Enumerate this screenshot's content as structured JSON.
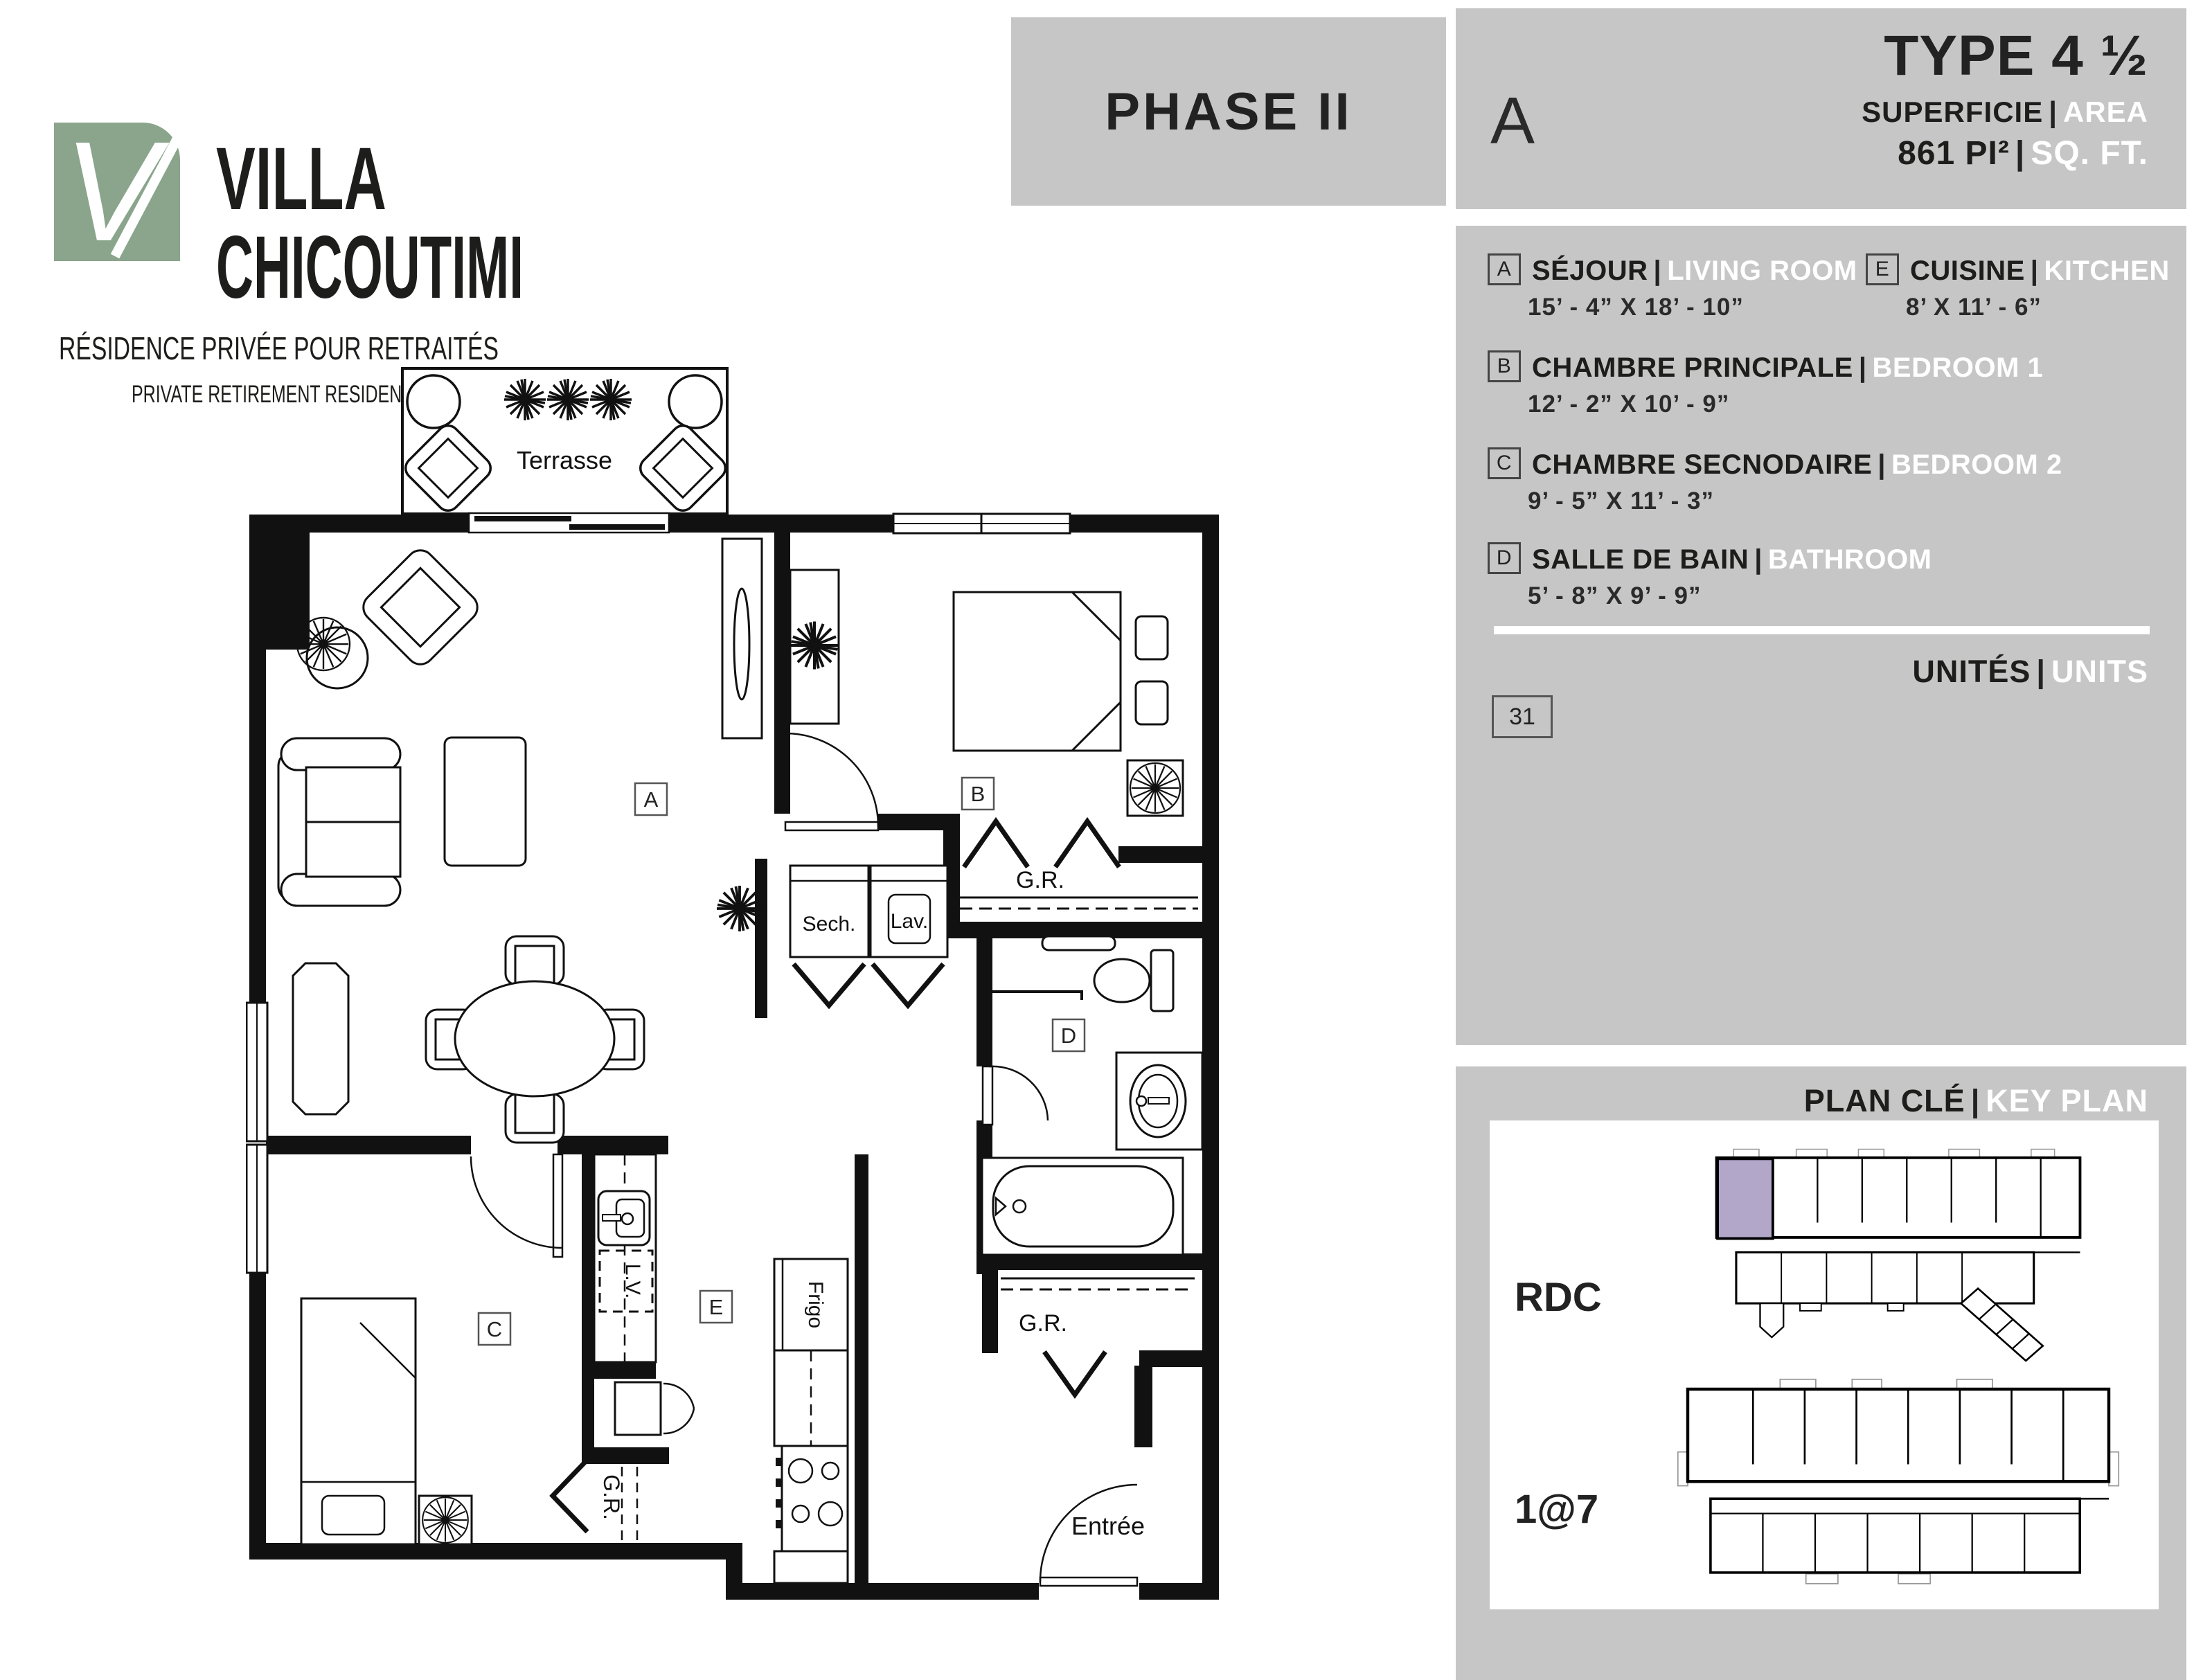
{
  "brand": {
    "name_line1": "VILLA",
    "name_line2": "CHICOUTIMI",
    "tagline_fr": "RÉSIDENCE PRIVÉE POUR RETRAITÉS",
    "tagline_en": "PRIVATE RETIREMENT RESIDENCE",
    "monogram": "V"
  },
  "phase": {
    "label": "PHASE II"
  },
  "unit_header": {
    "unit_letter": "A",
    "type_label": "TYPE 4 ½",
    "superficie_fr": "SUPERFICIE",
    "superficie_en": "AREA",
    "area_value_fr": "861 PI²",
    "area_value_en": "SQ. FT."
  },
  "legend": {
    "items": [
      {
        "badge": "A",
        "name_fr": "SÉJOUR",
        "name_en": "LIVING ROOM",
        "dims": "15’ - 4” X 18’ - 10”"
      },
      {
        "badge": "B",
        "name_fr": "CHAMBRE PRINCIPALE",
        "name_en": "BEDROOM 1",
        "dims": "12’ - 2” X 10’ - 9”"
      },
      {
        "badge": "C",
        "name_fr": "CHAMBRE SECNODAIRE",
        "name_en": "BEDROOM 2",
        "dims": "9’ - 5” X 11’ - 3”"
      },
      {
        "badge": "D",
        "name_fr": "SALLE DE BAIN",
        "name_en": "BATHROOM",
        "dims": "5’ - 8” X 9’ - 9”"
      },
      {
        "badge": "E",
        "name_fr": "CUISINE",
        "name_en": "KITCHEN",
        "dims": "8’ X 11’ - 6”"
      }
    ],
    "units_fr": "UNITÉS",
    "units_en": "UNITS",
    "unit_numbers": [
      "31"
    ]
  },
  "key_plan": {
    "title_fr": "PLAN CLÉ",
    "title_en": "KEY PLAN",
    "floors": [
      {
        "label": "RDC"
      },
      {
        "label": "1@7"
      }
    ]
  },
  "floor_plan": {
    "labels": {
      "terrasse": "Terrasse",
      "room_a": "A",
      "room_b": "B",
      "room_c": "C",
      "room_d": "D",
      "room_e": "E",
      "gr": "G.R.",
      "sech": "Sech.",
      "lav": "Lav.",
      "lv": "L.V.",
      "frigo": "Frigo",
      "entree": "Entrée"
    }
  },
  "colors": {
    "panel_gray": "#c6c6c6",
    "accent_green": "#8aa58c",
    "highlight_purple": "#b2a6c9",
    "text_black": "#1d1d1b",
    "text_white": "#ffffff"
  }
}
